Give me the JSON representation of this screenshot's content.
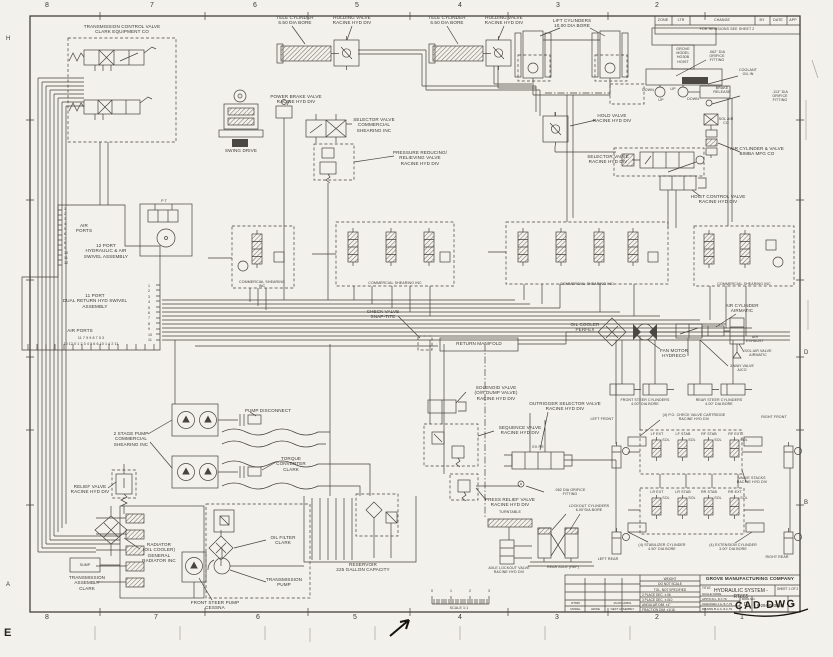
{
  "zones": {
    "top": [
      "8",
      "7",
      "6",
      "5",
      "4",
      "3",
      "2"
    ],
    "bottom": [
      "8",
      "7",
      "6",
      "5",
      "4",
      "3",
      "2",
      "1"
    ],
    "left": [
      "H",
      "A"
    ],
    "right": [
      "D",
      "B"
    ],
    "ruler": [
      "0",
      "1",
      "2",
      "3"
    ]
  },
  "rev_strip": {
    "cols": [
      "ZONE",
      "LTR",
      "CHANGE",
      "BY",
      "DATE",
      "APP"
    ],
    "note": "FOR REVISIONS SEE SHEET 2"
  },
  "title_block": {
    "company": "GROVE MANUFACTURING COMPANY",
    "title_label": "TITLE",
    "title": "HYDRAULIC SYSTEM - RT665",
    "sheet": "SHEET 1 OF 2",
    "sign_rows": [
      "APP'D  R.L.  8-7-79",
      "CHECKED  J.A.  8-7-79",
      "DRAWN  B.A.A.  8-2-79"
    ],
    "scale": "SCALE  NONE",
    "dwg_no_label": "DWG NO.",
    "size": "D",
    "dwg_no": "6-294-003858",
    "rev": "B",
    "weight": "WEIGHT",
    "do_not_scale": "DO NOT SCALE",
    "tol_header": "TOL. NOT SPECIFIED",
    "tols": [
      "2 PLACE DEC.  ±.06",
      "3 PLACE DEC.  ±.010",
      "ANGULAR DIM.  ±1°",
      "FRACTION DIM.  ±1/16"
    ],
    "model_headers": [
      "MODEL",
      "HDWE",
      "NEXT ASSEMBLY"
    ],
    "model_value": "RT665",
    "next_assembly_value": "26-054-00561"
  },
  "stamp": {
    "cad": "CAD DWG",
    "corner": "E"
  },
  "components": {
    "transmission_control_valve": "TRANSMISSION CONTROL VALVE\nCLARK EQUIPMENT CO",
    "tele_cylinder_1": "TELE CYLINDER\n6.50 DIA BORE",
    "holding_valve_1": "HOLDING VALVE\nRACINE HYD DIV",
    "tele_cylinder_2": "TELE CYLINDER\n6.50 DIA BORE",
    "holding_valve_2": "HOLDING VALVE\nRACINE HYD DIV",
    "lift_cylinders": "LIFT CYLINDERS\n10.00 DIA BORE",
    "grove_hoist": "GROVE\nMODEL\nHO30B\nHOIST",
    "orifice_062_top": ".062\" DIA\nORIFICE\nFITTING",
    "coolant_oil_in": "COOLANT\nOIL IN",
    "brake_release": "BRAKE\nRELEASE",
    "orifice_113": ".113\" DIA\nORIFICE\nFITTING",
    "power_brake_valve": "POWER BRAKE VALVE\nRACINE HYD DIV",
    "swing_drive": "SWING DRIVE",
    "selector_valve_commercial": "SELECTOR VALVE\nCOMMERCIAL\nSHEARING INC",
    "pressure_reducing_valve": "PRESSURE REDUCING/\nRELIEVING VALVE\nRACINE HYD DIV",
    "hold_valve": "HOLD VALVE\nRACINE HYD DIV",
    "sol_air_co": "SOL AIR\nCO",
    "air_cylinder_bimba": "AIR CYLINDER & VALVE\nBIMBA MFG CO",
    "selector_valve_racine": "SELECTOR VALVE\nRACINE HYD DIV",
    "hoist_control_valve": "HOIST CONTROL VALVE\nRACINE HYD DIV",
    "hoist_down_l": "DOWN",
    "hoist_up_l": "UP",
    "hoist_up_r": "UP",
    "hoist_down_r": "DOWN",
    "air_ports_top": "AIR\nPORTS",
    "swivel_12_port": "12 PORT\nHYDRAULIC & AIR\nSWIVEL ASSEMBLY",
    "swivel_11_port": "11 PORT\nDUAL RETURN HYD  SWIVEL\nASSEMBLY",
    "air_ports_bottom": "AIR PORTS",
    "ports_left": "1\n2\n3\n4\n5\n6\n7\n8\n9\n10\n11\n12",
    "ports_right": "1\n2\n3\n4\n5\n6\n7\n8\n9\n10\n11",
    "ports_bottom_1": "11  7  9                 9  8  7  5  3",
    "ports_bottom_2": "10 12 0   1 2 3 4 5 6   6 10 1 4 2 11",
    "pilot_pt": "P      T",
    "commercial_shearing_1": "COMMERCIAL SHEARING\nINC",
    "commercial_shearing_2": "COMMERCIAL  SHEARING  INC",
    "commercial_shearing_3": "COMMERCIAL  SHEARING  INC",
    "commercial_shearing_4": "COMMERCIAL  SHEARING  INC",
    "check_valve_snaptite": "CHECK VALVE\nSNAP-TITE",
    "return_manifold": "RETURN MANIFOLD",
    "oil_cooler_perfex": "OIL COOLER\nPERFEX",
    "fan_motor_hydreco": "FAN MOTOR\nHYDRECO",
    "air_cylinder_airmatic": "AIR CYLINDER\nAIRMATIC",
    "air_exhaust": "AIR\nEXHAUST",
    "sol_air_valve_airmatic": "SOL AIR VALVE\nAIRMATIC",
    "three_way_valve_aico": "3-WAY VALVE\nAICO",
    "solenoid_valve": "SOLENOID VALVE\n(O/R DUMP VALVE)\nRACINE HYD DIV",
    "outrigger_selector_valve": "OUTRIGGER SELECTOR VALVE\nRACINE HYD DIV",
    "selector_ports": "EX      PR",
    "front_steer_cylinders": "FRONT STEER CYLINDERS\n4.00\" DIA BORE",
    "rear_steer_cylinders": "REAR STEER CYLINDERS\n4.00\" DIA BORE",
    "po_check_valve": "(4) P.O. CHECK VALVE CARTRIDGE\nRACINE HYD DIV",
    "left_front": "LEFT FRONT",
    "right_front": "RIGHT FRONT",
    "valve_stacks": "VALVE STACKS\nRACINE HYD DIV",
    "lf_ext": "LF EXT",
    "lf_stab": "LF STAB",
    "rf_stab": "RF STAB",
    "rf_ext": "RF EXT",
    "lr_ext": "LR EXT",
    "lr_stab": "LR STAB",
    "rr_stab": "RR STAB",
    "rr_ext": "RR EXT",
    "sol": "SOL",
    "stabilizer_cylinder": "(4) STABILIZER CYLINDER\n4.50\" DIA BORE",
    "extension_cylinder": "(4) EXTENSION CYLINDER\n3.00\" DIA BORE",
    "left_rear": "LEFT REAR",
    "right_rear": "RIGHT REAR",
    "sequence_valve": "SEQUENCE VALVE\nRACINE HYD DIV",
    "press_relief_valve": "PRESS RELIEF VALVE\nRACINE HYD DIV",
    "orifice_062_bottom": ".062 DIA ORIFICE\nFITTING",
    "turntable": "TURNTABLE",
    "lockout_cylinders": "LOCKOUT CYLINDERS\n6.00\"DIA BORE",
    "axle_lockout_valve": "AXLE LOCKOUT VALVE\nRACINE HYD DIV",
    "rear_axle_ref": "REAR AXLE (REF)",
    "two_stage_pump": "2 STAGE PUMP\nCOMMERCIAL\nSHEARING INC",
    "pump_disconnect": "PUMP DISCONNECT",
    "torque_converter": "TORQUE\nCONVERTER\nCLARK",
    "relief_valve": "RELIEF VALVE\nRACINE HYD DIV",
    "radiator": "RADIATOR\n(OIL COOLER)\nGENERAL\nRADIATOR INC",
    "oil_filter": "OIL FILTER\nCLARK",
    "transmission_assembly": "TRANSMISSION\nASSEMBLY\nCLARK",
    "sump": "SUMP",
    "front_steer_pump": "FRONT STEER PUMP\nCESSNA",
    "transmission_pump": "TRANSMISSION\nPUMP",
    "reservoir": "RESERVOIR\n225 GALLON CAPACITY",
    "scale_label": "SCALE 1:1"
  }
}
